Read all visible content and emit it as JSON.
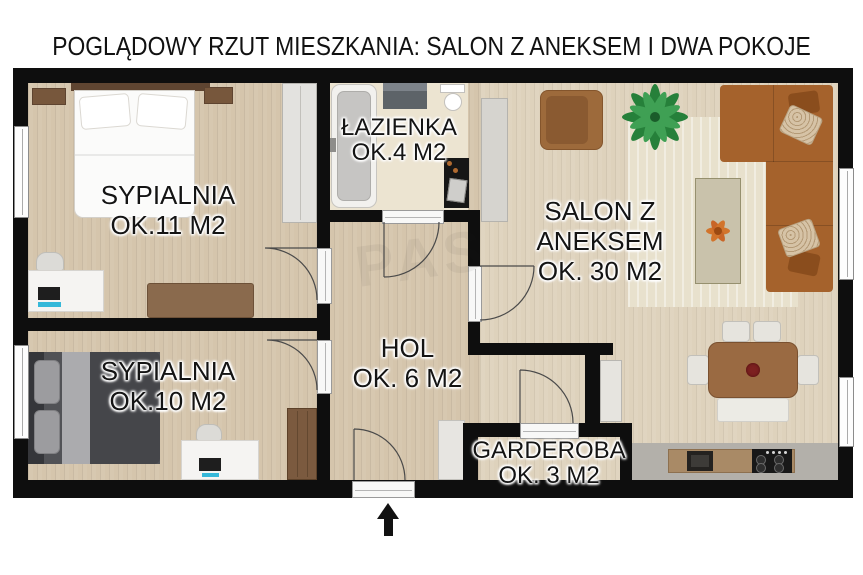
{
  "title": "POGLĄDOWY RZUT MIESZKANIA: SALON Z ANEKSEM I DWA POKOJE",
  "entrance": {
    "symbol": "entrance-arrow",
    "wall": "bottom"
  },
  "watermark_text": "PAS",
  "rooms": {
    "bedroom_large": {
      "name": "SYPIALNIA",
      "area": "OK.11 M2",
      "furniture": [
        "double-bed",
        "nightstand",
        "nightstand",
        "wardrobe",
        "desk",
        "desk-chair",
        "laptop",
        "dresser"
      ]
    },
    "bathroom": {
      "name": "ŁAZIENKA",
      "area": "OK.4 M2",
      "furniture": [
        "bathtub",
        "vanity-sink",
        "toilet",
        "washing-machine"
      ]
    },
    "living_room": {
      "name_line1": "SALON Z",
      "name_line2": "ANEKSEM",
      "area": "OK. 30 M2",
      "furniture": [
        "corner-sofa",
        "armchair",
        "palm-plant",
        "rug",
        "coffee-table",
        "flowers",
        "dining-table",
        "dining-chairs",
        "bench",
        "sideboard",
        "fridge",
        "kitchen-counter",
        "oven",
        "cooktop"
      ]
    },
    "bedroom_small": {
      "name": "SYPIALNIA",
      "area": "OK.10 M2",
      "furniture": [
        "double-bed",
        "desk",
        "desk-chair",
        "laptop",
        "wardrobe"
      ]
    },
    "hall": {
      "name": "HOL",
      "area": "OK. 6 M2",
      "furniture": [
        "cabinet"
      ]
    },
    "wardrobe_room": {
      "name": "GARDEROBA",
      "area": "OK. 3 M2",
      "furniture": []
    }
  },
  "colors": {
    "wall": "#0e0e0e",
    "floor_wood": "#d5c5ac",
    "floor_salon": "#ded2bc",
    "floor_bath": "#ece4d1",
    "floor_kitchen": "#b3b0aa",
    "sofa": "#a5622c",
    "rug": "#e8e1cd",
    "accent_cyan": "#35b8d9",
    "plant_green": "#26803a",
    "flower_orange": "#d2742b",
    "text": "#141414"
  }
}
